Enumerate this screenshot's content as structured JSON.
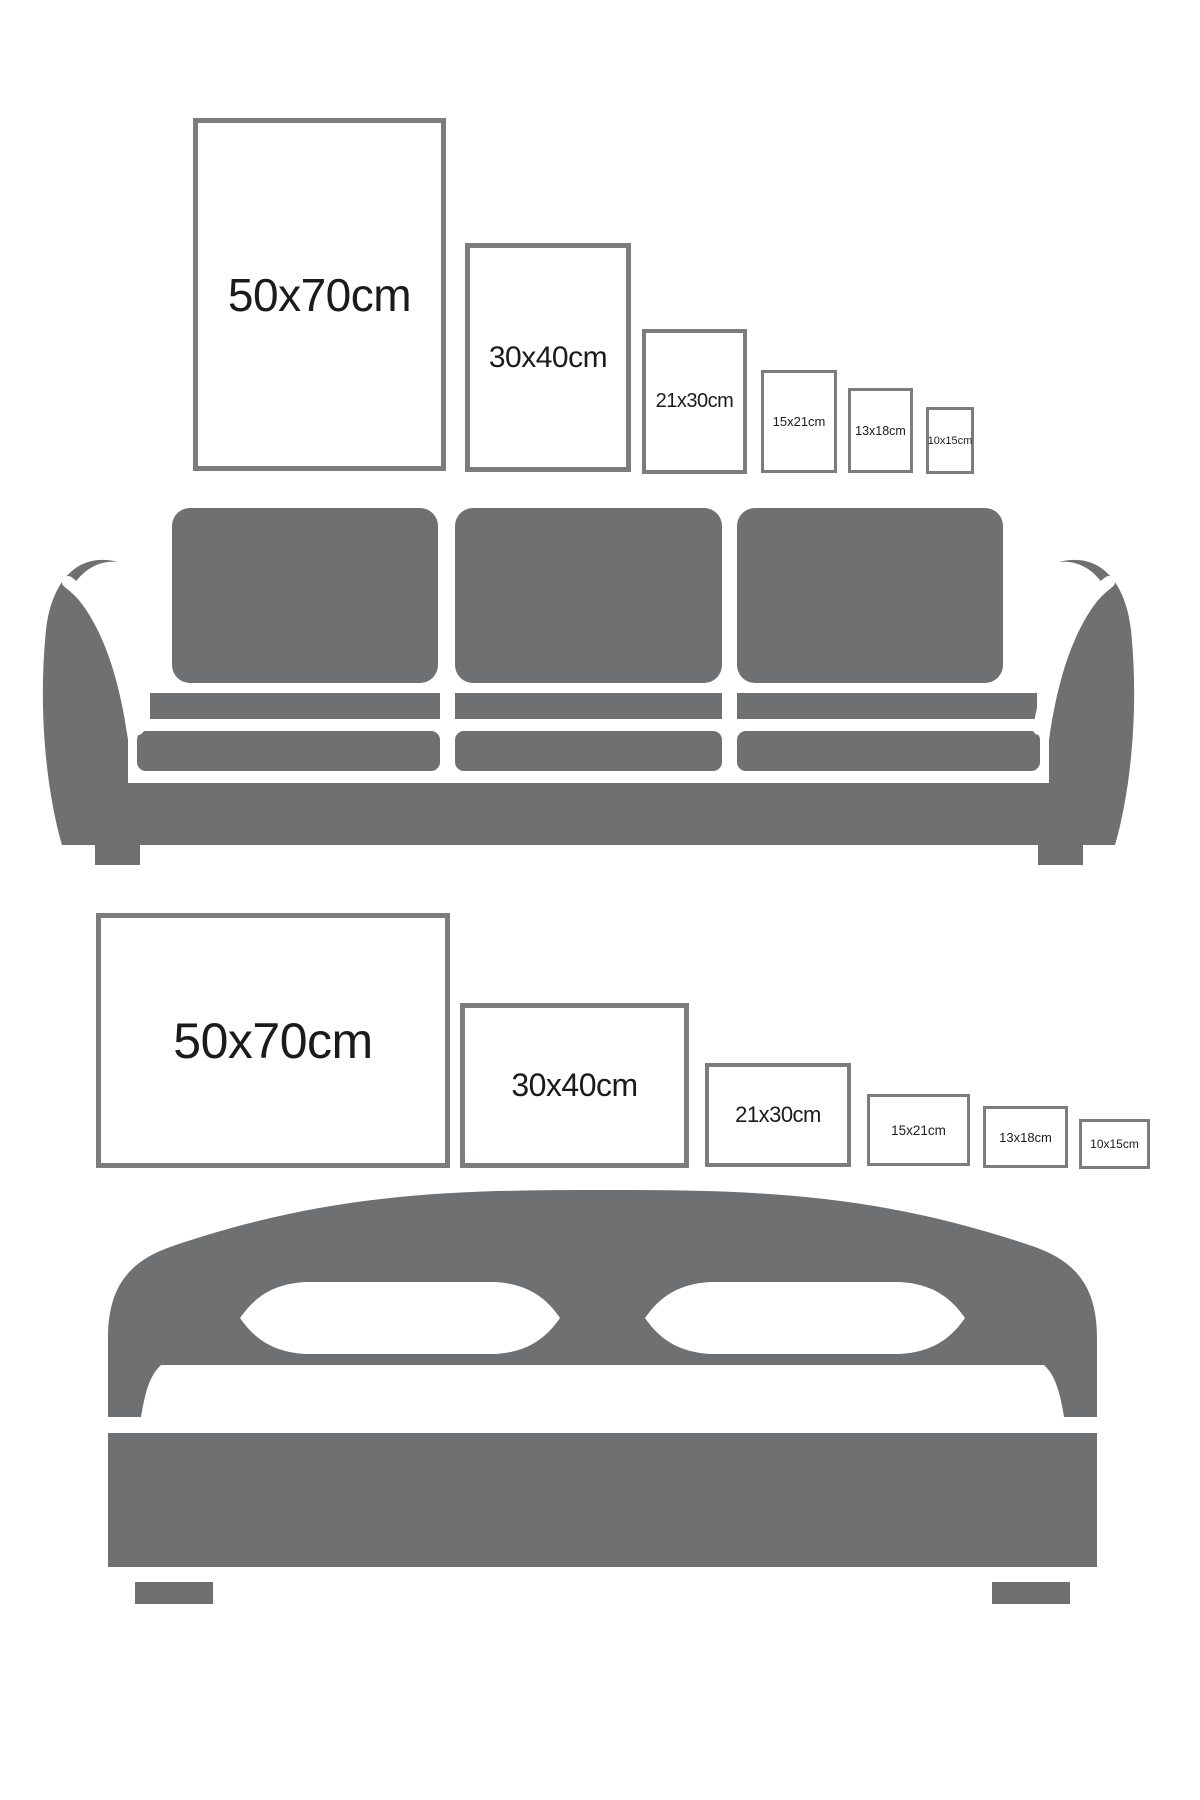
{
  "page": {
    "title": "Poster frame size guide",
    "background": "#ffffff"
  },
  "colors": {
    "furniture_gray": "#6f7072",
    "frame_border_gray": "#7b7c7e",
    "label_text": "#1b1b1b"
  },
  "sofa_section": {
    "furniture": "sofa",
    "orientation": "portrait",
    "frames": [
      {
        "label": "50x70cm",
        "width_cm": 50,
        "height_cm": 70
      },
      {
        "label": "30x40cm",
        "width_cm": 30,
        "height_cm": 40
      },
      {
        "label": "21x30cm",
        "width_cm": 21,
        "height_cm": 30
      },
      {
        "label": "15x21cm",
        "width_cm": 15,
        "height_cm": 21
      },
      {
        "label": "13x18cm",
        "width_cm": 13,
        "height_cm": 18
      },
      {
        "label": "10x15cm",
        "width_cm": 10,
        "height_cm": 15
      }
    ]
  },
  "bed_section": {
    "furniture": "bed",
    "orientation": "landscape",
    "frames": [
      {
        "label": "50x70cm",
        "width_cm": 70,
        "height_cm": 50
      },
      {
        "label": "30x40cm",
        "width_cm": 40,
        "height_cm": 30
      },
      {
        "label": "21x30cm",
        "width_cm": 30,
        "height_cm": 21
      },
      {
        "label": "15x21cm",
        "width_cm": 21,
        "height_cm": 15
      },
      {
        "label": "13x18cm",
        "width_cm": 18,
        "height_cm": 13
      },
      {
        "label": "10x15cm",
        "width_cm": 15,
        "height_cm": 10
      }
    ]
  }
}
